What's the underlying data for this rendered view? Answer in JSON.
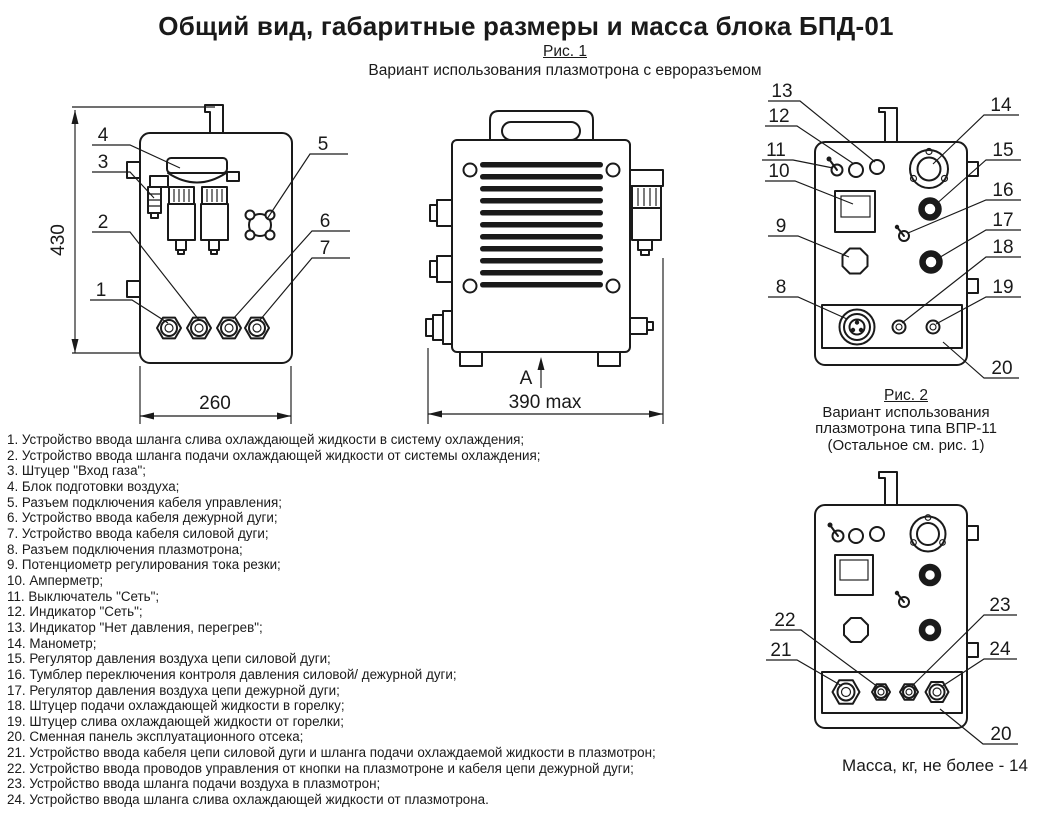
{
  "page": {
    "title": "Общий вид, габаритные размеры и масса блока БПД-01",
    "mass_note": "Масса, кг, не более - 14"
  },
  "fig1": {
    "caption": "Рис. 1",
    "subtitle": "Вариант использования плазмотрона с евроразъемом",
    "left_view": {
      "dim_height": "430",
      "dim_width": "260",
      "callouts": {
        "c1": "1",
        "c2": "2",
        "c3": "3",
        "c4": "4",
        "c5": "5",
        "c6": "6",
        "c7": "7"
      }
    },
    "front_view": {
      "dim_width": "390 max",
      "view_arrow": "A"
    },
    "panel_view": {
      "callouts": {
        "c8": "8",
        "c9": "9",
        "c10": "10",
        "c11": "11",
        "c12": "12",
        "c13": "13",
        "c14": "14",
        "c15": "15",
        "c16": "16",
        "c17": "17",
        "c18": "18",
        "c19": "19",
        "c20": "20"
      }
    }
  },
  "fig2": {
    "caption": "Рис. 2",
    "subtitle_lines": [
      "Вариант использования",
      "плазмотрона типа ВПР-11",
      "(Остальное см. рис. 1)"
    ],
    "callouts": {
      "c20": "20",
      "c21": "21",
      "c22": "22",
      "c23": "23",
      "c24": "24"
    }
  },
  "legend": {
    "items": [
      "1. Устройство ввода шланга слива охлаждающей жидкости в систему охлаждения;",
      "2. Устройство ввода шланга подачи охлаждающей жидкости от системы охлаждения;",
      "3. Штуцер \"Вход газа\";",
      "4. Блок подготовки воздуха;",
      "5. Разъем подключения кабеля управления;",
      "6. Устройство ввода кабеля дежурной дуги;",
      "7. Устройство ввода кабеля силовой дуги;",
      "8. Разъем подключения плазмотрона;",
      "9. Потенциометр регулирования тока резки;",
      "10. Амперметр;",
      "11. Выключатель \"Сеть\";",
      "12. Индикатор \"Сеть\";",
      "13. Индикатор \"Нет давления, перегрев\";",
      "14. Манометр;",
      "15. Регулятор давления воздуха цепи силовой дуги;",
      "16. Тумблер переключения контроля давления силовой/ дежурной дуги;",
      "17. Регулятор давления воздуха цепи дежурной дуги;",
      "18. Штуцер подачи охлаждающей жидкости в горелку;",
      "19. Штуцер слива охлаждающей жидкости от горелки;",
      "20. Сменная панель эксплуатационного отсека;",
      "21. Устройство ввода кабеля цепи силовой дуги и шланга подачи охлаждаемой жидкости в плазмотрон;",
      "22. Устройство ввода проводов управления от кнопки на плазмотроне и кабеля цепи дежурной дуги;",
      "23. Устройство ввода шланга подачи воздуха в плазмотрон;",
      "24. Устройство ввода шланга слива охлаждающей жидкости от плазмотрона."
    ]
  }
}
